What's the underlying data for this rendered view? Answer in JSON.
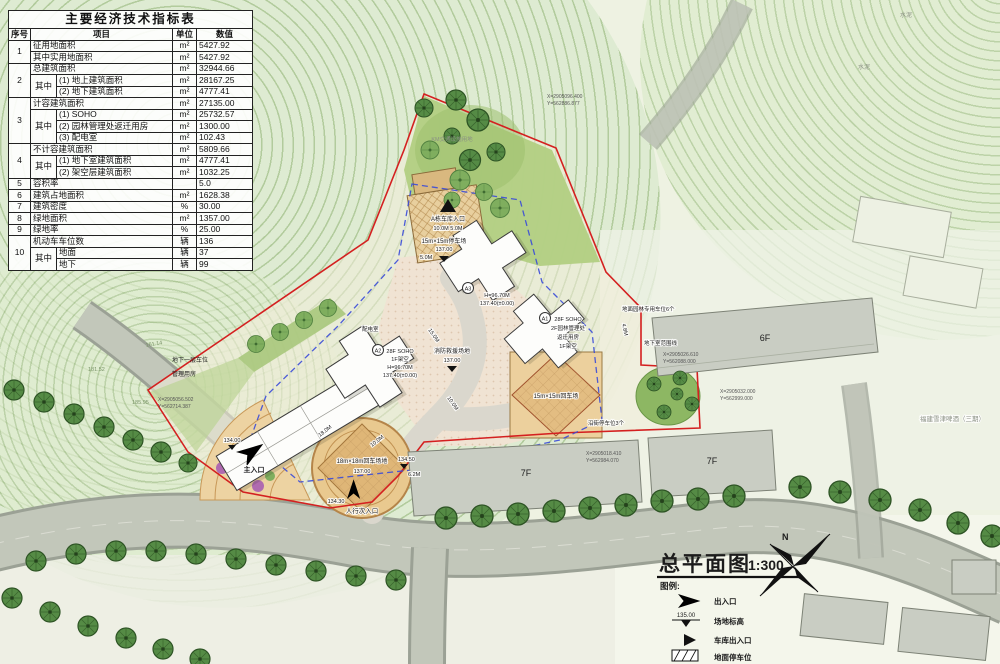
{
  "table": {
    "title": "主要经济技术指标表",
    "h_no": "序号",
    "h_item": "项目",
    "h_unit": "单位",
    "h_value": "数值",
    "rows": [
      {
        "no": "1",
        "item": "征用地面积",
        "unit": "m²",
        "value": "5427.92"
      },
      {
        "item": "其中实用地面积",
        "unit": "m²",
        "value": "5427.92"
      },
      {
        "no": "2",
        "item": "总建筑面积",
        "unit": "m²",
        "value": "32944.66"
      },
      {
        "mid": "其中",
        "item": "(1) 地上建筑面积",
        "unit": "m²",
        "value": "28167.25"
      },
      {
        "item": "(2) 地下建筑面积",
        "unit": "m²",
        "value": "4777.41"
      },
      {
        "no": "3",
        "item": "计容建筑面积",
        "unit": "m²",
        "value": "27135.00"
      },
      {
        "mid": "其中",
        "item": "(1) SOHO",
        "unit": "m²",
        "value": "25732.57"
      },
      {
        "item": "(2) 园林管理处返迁用房",
        "unit": "m²",
        "value": "1300.00"
      },
      {
        "item": "(3) 配电室",
        "unit": "m²",
        "value": "102.43"
      },
      {
        "no": "4",
        "item": "不计容建筑面积",
        "unit": "m²",
        "value": "5809.66"
      },
      {
        "mid": "其中",
        "item": "(1) 地下室建筑面积",
        "unit": "m²",
        "value": "4777.41"
      },
      {
        "item": "(2) 架空层建筑面积",
        "unit": "m²",
        "value": "1032.25"
      },
      {
        "no": "5",
        "item": "容积率",
        "unit": "",
        "value": "5.0"
      },
      {
        "no": "6",
        "item": "建筑占地面积",
        "unit": "m²",
        "value": "1628.38"
      },
      {
        "no": "7",
        "item": "建筑密度",
        "unit": "%",
        "value": "30.00"
      },
      {
        "no": "8",
        "item": "绿地面积",
        "unit": "m²",
        "value": "1357.00"
      },
      {
        "no": "9",
        "item": "绿地率",
        "unit": "%",
        "value": "25.00"
      },
      {
        "no": "10",
        "item": "机动车车位数",
        "unit": "辆",
        "value": "136"
      },
      {
        "mid": "其中",
        "item": "地面",
        "unit": "辆",
        "value": "37"
      },
      {
        "item": "地下",
        "unit": "辆",
        "value": "99"
      }
    ]
  },
  "plan": {
    "garage_entry_label": "A栋车库入口",
    "garage_entry_dims": "10.0M  5.0M",
    "pad_label": "15m×15m停车场",
    "pad_elev": "137.00",
    "pad_dim": "5.0M",
    "a3_id": "A3",
    "a3_h": "H=96.70M",
    "a3_elev": "137.40(±0.00)",
    "a2_id": "A2",
    "a2_use": "28F SOHO",
    "a2_l2": "1F架空",
    "a2_h": "H=96.70M",
    "a2_elev": "137.40(±0.00)",
    "a1_id": "A1",
    "a1_use": "28F SOHO",
    "a1_l2": "2F园林管理处",
    "a1_l3": "返迁用房",
    "a1_l4": "1F架空",
    "fire_label": "消防救援场地",
    "fire_elev": "137.00",
    "turn_r_label": "15m×15m回车场",
    "turn_m_label": "18m×18m回车场地",
    "turn_m_elev": "137.00",
    "main_entry": "主入口",
    "main_entry_elev": "134.00",
    "ped_entry": "人行次入口",
    "ped_entry_elev": "134.30",
    "power_room": "配电室",
    "left_l1": "地下一层车位",
    "left_l2": "管理用房",
    "park_note": "KM交通设施用地",
    "garden_parking": "地面园林专用车位6个",
    "street_parking": "沿街停车位3个",
    "basement_line": "地下室范围线",
    "f6": "6F",
    "f7a": "7F",
    "f7b": "7F",
    "beer": "福建雪津啤酒（三期）",
    "cement": "水泥",
    "elev_13450": "134.50",
    "dim_18": "18.0M",
    "dim_10": "10.0M",
    "dim_15": "15.0M",
    "dim_10b": "10.0M",
    "dim_48": "4.8M",
    "dim_62": "6.2M",
    "contour1": "161.14",
    "contour2": "181.52",
    "contour3": "185.95",
    "coords": [
      {
        "x": "X=2905056.502",
        "y": "Y=562714.387"
      },
      {
        "x": "X=2905018.410",
        "y": "Y=562984.070"
      },
      {
        "x": "X=2905032.000",
        "y": "Y=562999.000"
      },
      {
        "x": "X=2905026.610",
        "y": "Y=562088.000"
      },
      {
        "x": "X=2905096.400",
        "y": "Y=562886.877"
      }
    ]
  },
  "titleblock": {
    "title": "总平面图",
    "scale": "1:300",
    "north": "N"
  },
  "legend": {
    "heading": "图例:",
    "entry_exit": "出入口",
    "site_elev_label": "场地标高",
    "site_elev_value": "135.00",
    "garage_entry": "车库出入口",
    "surface_parking": "地面停车位"
  },
  "colors": {
    "boundary_red": "#d42020",
    "garage_blue": "#3a4bd8",
    "tree_green": "#558b45",
    "plaza_tan": "#e8cf9e"
  }
}
